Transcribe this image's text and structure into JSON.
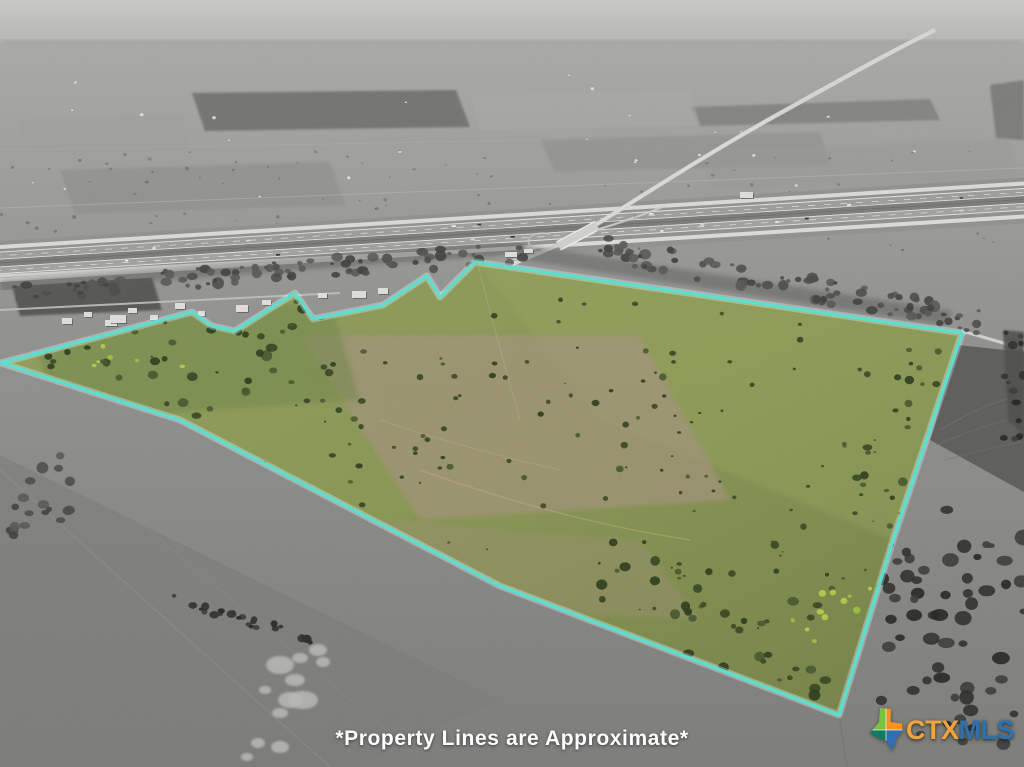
{
  "photo": {
    "kind": "aerial-drone-photo",
    "caption": "*Property Lines are Approximate*",
    "caption_color": "#ffffff"
  },
  "boundary": {
    "color": "#5BDECE",
    "glow_color": "#ffffff",
    "points": [
      [
        1,
        363
      ],
      [
        192,
        312
      ],
      [
        212,
        326
      ],
      [
        235,
        331
      ],
      [
        295,
        293
      ],
      [
        313,
        319
      ],
      [
        383,
        305
      ],
      [
        427,
        276
      ],
      [
        440,
        297
      ],
      [
        475,
        262
      ],
      [
        962,
        333
      ],
      [
        893,
        540
      ],
      [
        839,
        715
      ],
      [
        500,
        586
      ],
      [
        180,
        420
      ]
    ]
  },
  "brand": {
    "name": "CTXMLS",
    "text_primary": "CTX",
    "text_secondary": "MLS",
    "primary_color": "#F0A43C",
    "secondary_color": "#2F71AC",
    "icon": "texas-state-icon",
    "icon_colors": {
      "top_left": "#7CC242",
      "top_right": "#F7941E",
      "bottom_left": "#0E7B63",
      "bottom_right": "#2C6FB5"
    }
  },
  "palette": {
    "sky_haze": "#c7c7c4",
    "farmland_gray": "#949492",
    "property_green": "#879552",
    "property_bare_tan": "#a79180",
    "shrub_green": "#2a3a1a"
  }
}
